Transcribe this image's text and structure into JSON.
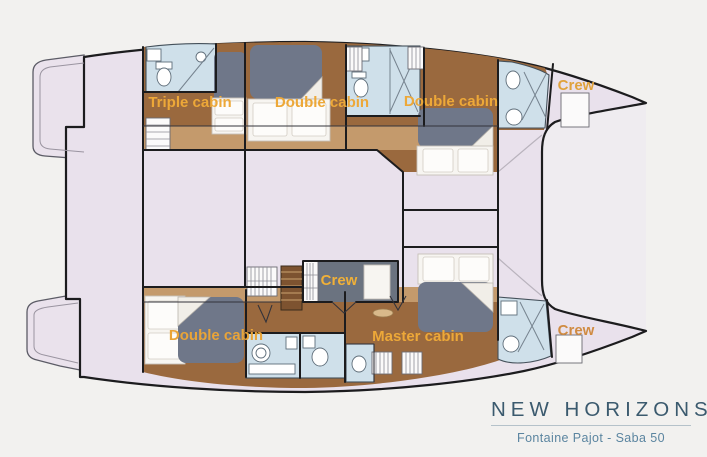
{
  "background": "#f2f1ef",
  "plan": {
    "colors": {
      "deck": "#e9e1ec",
      "outline": "#1c1c1e",
      "wood_dark": "#9a693e",
      "wood_light": "#c49a6c",
      "bed_gray": "#6f7789",
      "linen_white": "#f7f5f1",
      "bathroom_blue": "#cfe0ea",
      "label_orange": "#eda838"
    },
    "labels": [
      {
        "id": "triple-cabin",
        "text": "Triple cabin",
        "color": "#eda838"
      },
      {
        "id": "double-cabin-aft-port",
        "text": "Double cabin",
        "color": "#eda838"
      },
      {
        "id": "double-cabin-fwd-port",
        "text": "Double cabin",
        "color": "#eda838"
      },
      {
        "id": "crew-bow-port",
        "text": "Crew",
        "color": "#e0a23c"
      },
      {
        "id": "crew-midship",
        "text": "Crew",
        "color": "#f0b038"
      },
      {
        "id": "double-cabin-aft-starboard",
        "text": "Double cabin",
        "color": "#e9a438"
      },
      {
        "id": "master-cabin",
        "text": "Master cabin",
        "color": "#eda838"
      },
      {
        "id": "crew-bow-starboard",
        "text": "Crew",
        "color": "#d08b42"
      }
    ]
  },
  "title_block": {
    "title": "NEW HORIZONS 2",
    "subtitle": "Fontaine Pajot - Saba 50",
    "title_color": "#3b5a6e",
    "subtitle_color": "#5b85a0"
  }
}
